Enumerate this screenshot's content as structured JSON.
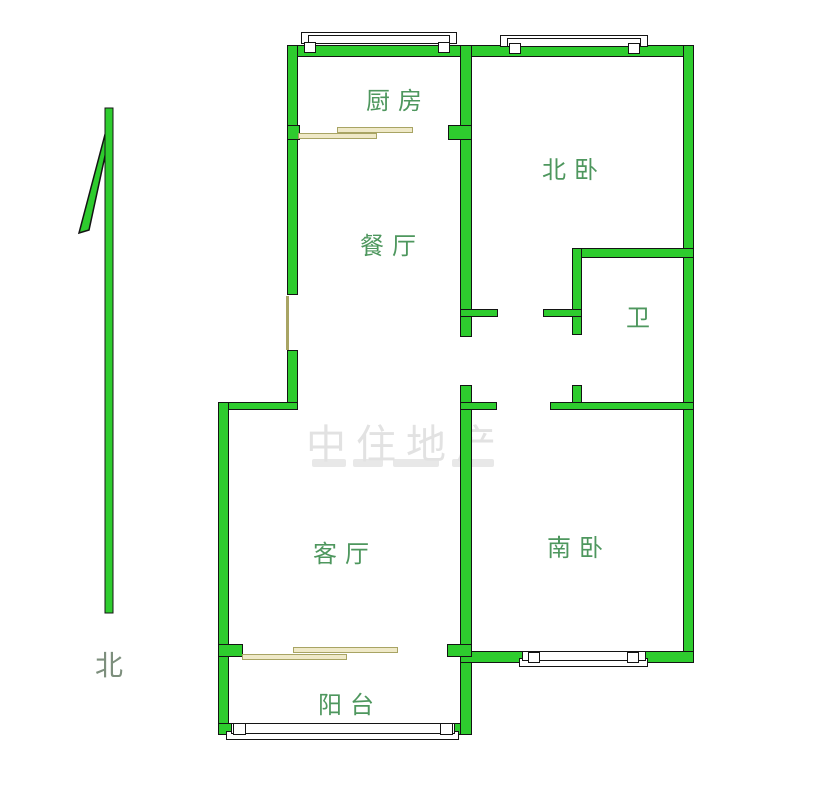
{
  "compass": {
    "label": "北"
  },
  "rooms": {
    "kitchen": {
      "label": "厨房"
    },
    "north_bedroom": {
      "label": "北卧"
    },
    "dining": {
      "label": "餐厅"
    },
    "bathroom": {
      "label": "卫"
    },
    "living": {
      "label": "客厅"
    },
    "south_bedroom": {
      "label": "南卧"
    },
    "balcony": {
      "label": "阳台"
    }
  },
  "watermark": {
    "line1": "中住地产"
  },
  "colors": {
    "wall": "#2ecc2e",
    "wall_outline": "#141414",
    "label": "#4e975e",
    "compass_label": "#7d8f7d",
    "door": "#efe9c8",
    "door_outline": "#a8a464",
    "window_fill": "#ffffff",
    "window_outline": "#141414",
    "watermark": "#e2e2e2"
  }
}
